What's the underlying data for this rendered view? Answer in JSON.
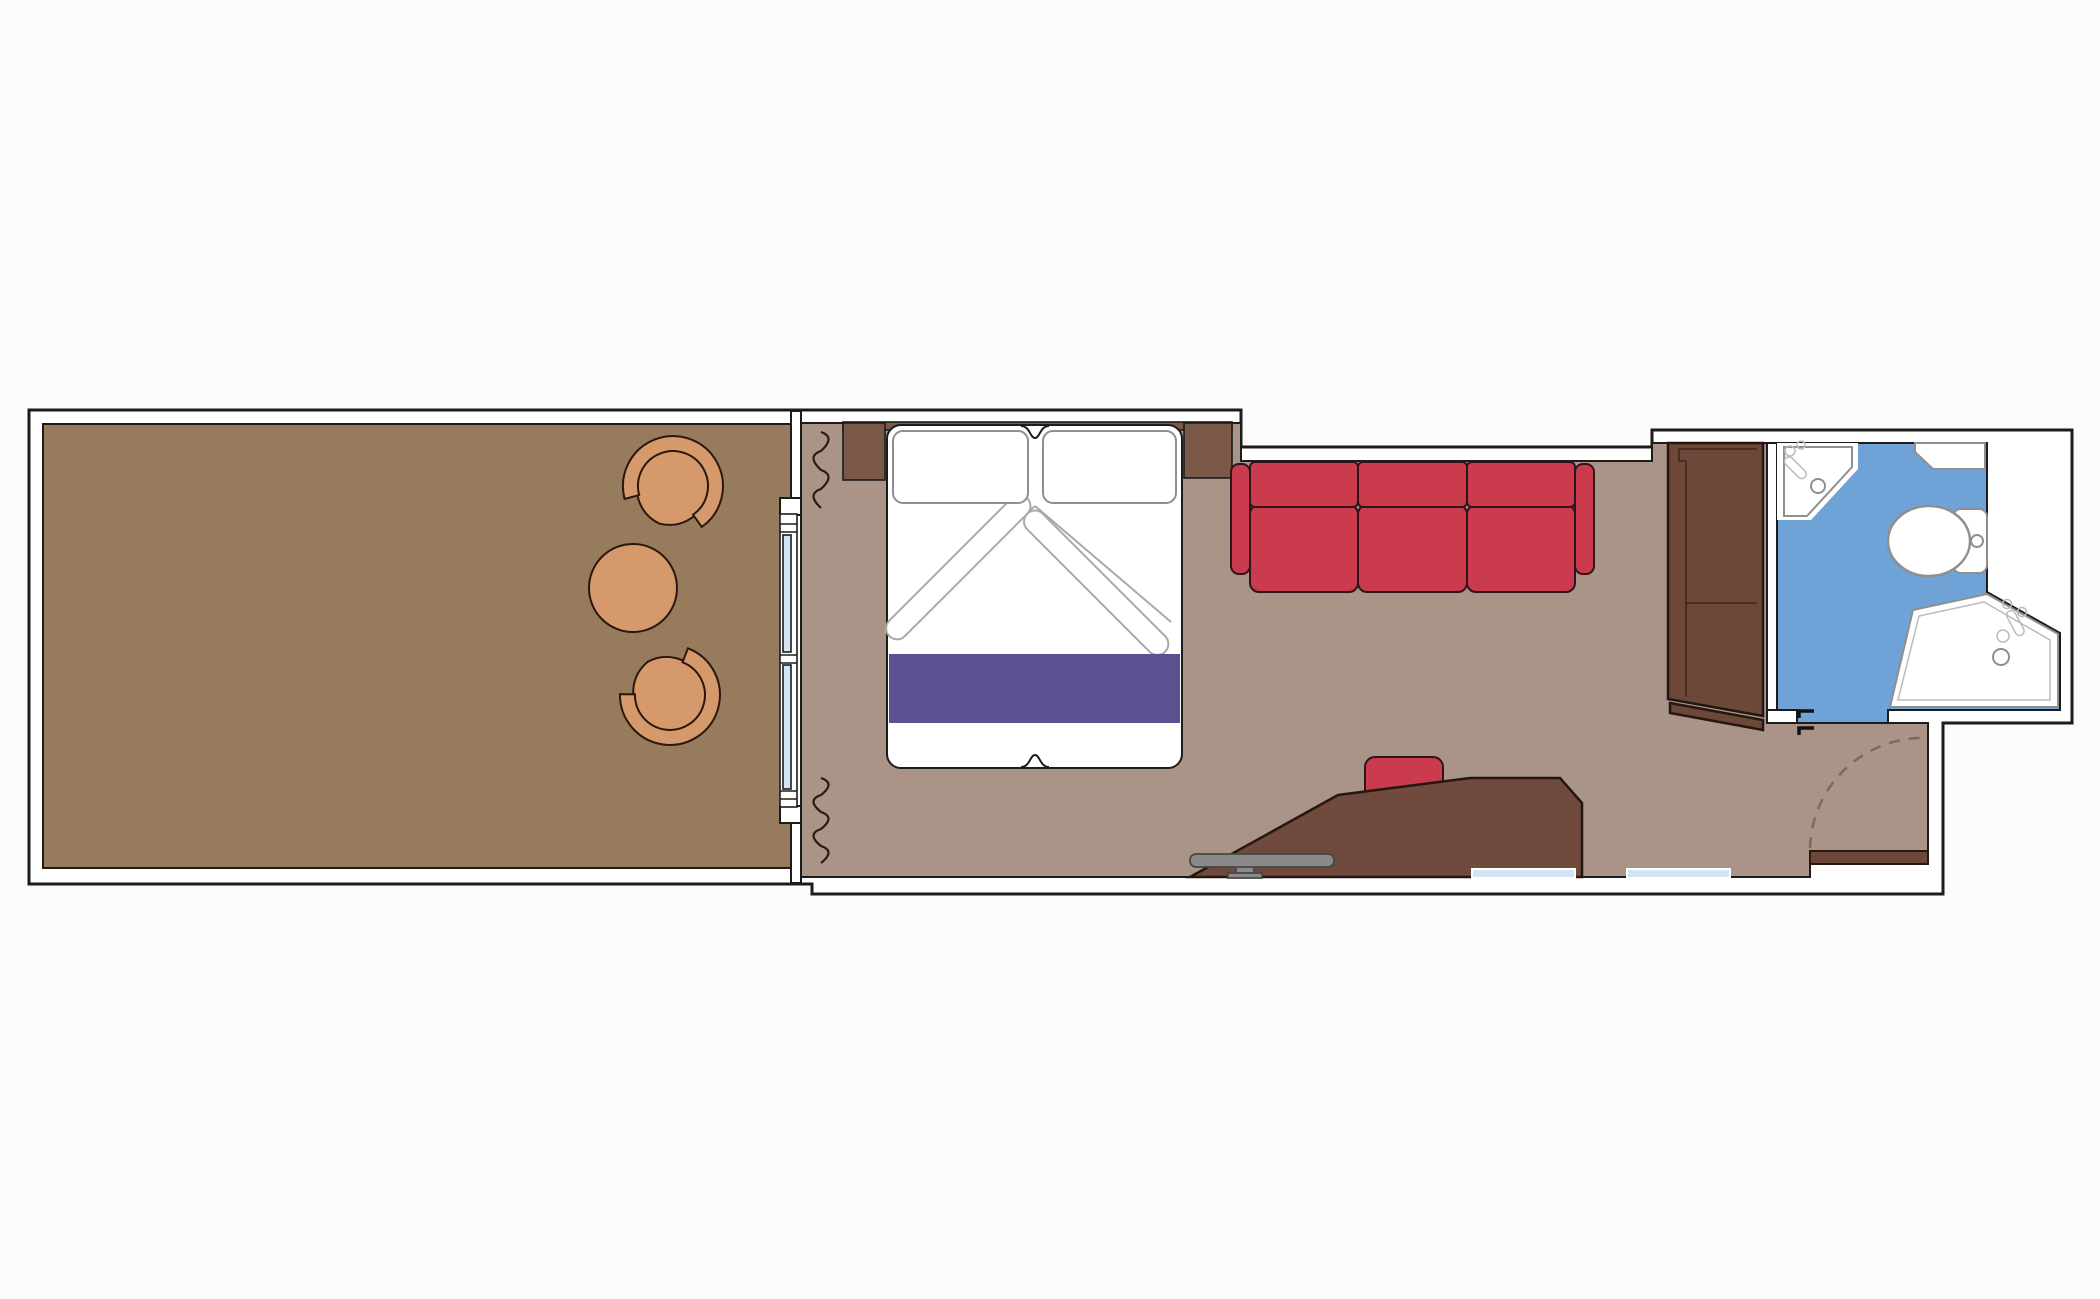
{
  "title": "Stateroom floor plan",
  "colors": {
    "background": "#fcfafa",
    "wall_fill": "#ffffff",
    "balcony_deck": "#977b5d",
    "room_floor": "#aa9487",
    "terracotta": "#d6996c",
    "bed_white": "#ffffff",
    "accent_purple": "#5a5190",
    "sofa_red": "#c93b4d",
    "headboard_wood": "#7a5949",
    "wardrobe_wood": "#6d4839",
    "desk_wood": "#6f4a3d",
    "door_wood": "#6b4839",
    "bathroom_blue": "#6fa3d7",
    "glass_blue": "#d4e4f3",
    "stool_gray": "#8a8a8a",
    "fixture_white": "#ffffff"
  },
  "rooms": {
    "balcony": "balcony",
    "bedroom": "bedroom",
    "living_area": "living-area",
    "bathroom": "bathroom",
    "entry": "entry"
  },
  "fixtures": [
    "balcony-chair",
    "balcony-chair",
    "balcony-table",
    "sliding-glass-door",
    "curtain",
    "curtain",
    "double-bed",
    "pillow",
    "pillow",
    "bed-runner",
    "nightstand",
    "nightstand",
    "sofa-three-seat",
    "wardrobe",
    "desk",
    "desk-chair",
    "stool",
    "washbasin",
    "shelf",
    "toilet",
    "shower",
    "bathroom-door-stop",
    "entrance-door",
    "door-swing"
  ]
}
